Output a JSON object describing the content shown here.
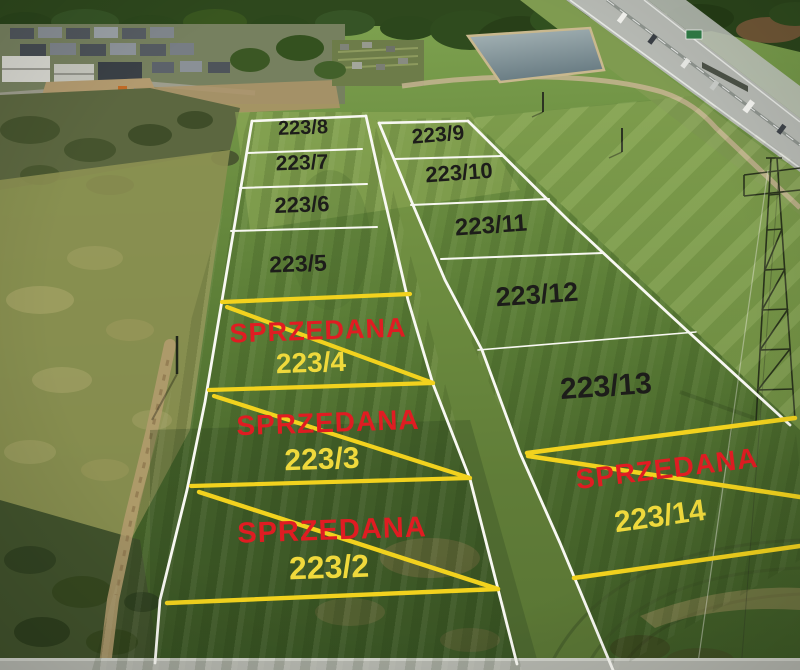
{
  "scene": {
    "type": "aerial-plot-sale-map",
    "sold_text": "SPRZEDANA",
    "colors": {
      "boundary_white": "#f8f8f2",
      "sold_yellow_line": "#f2d21e",
      "sold_red_text": "#e01c22",
      "sold_number_yellow": "#efd93c",
      "available_number_dark": "#1d1d1a"
    }
  },
  "plots": {
    "available": [
      {
        "number": "223/8",
        "x": 303,
        "y": 128,
        "size": 20,
        "rot": -2
      },
      {
        "number": "223/7",
        "x": 302,
        "y": 163,
        "size": 21,
        "rot": -2
      },
      {
        "number": "223/6",
        "x": 302,
        "y": 205,
        "size": 22,
        "rot": -2
      },
      {
        "number": "223/5",
        "x": 298,
        "y": 264,
        "size": 23,
        "rot": -2
      },
      {
        "number": "223/9",
        "x": 438,
        "y": 135,
        "size": 21,
        "rot": -5
      },
      {
        "number": "223/10",
        "x": 459,
        "y": 173,
        "size": 22,
        "rot": -4
      },
      {
        "number": "223/11",
        "x": 491,
        "y": 226,
        "size": 24,
        "rot": -4
      },
      {
        "number": "223/12",
        "x": 537,
        "y": 295,
        "size": 27,
        "rot": -4
      },
      {
        "number": "223/13",
        "x": 606,
        "y": 387,
        "size": 30,
        "rot": -4
      }
    ],
    "sold": [
      {
        "number": "223/4",
        "x": 311,
        "y": 363,
        "size": 28,
        "rot": -2,
        "badge_x": 318,
        "badge_y": 331,
        "badge_size": 27,
        "badge_rot": -2
      },
      {
        "number": "223/3",
        "x": 322,
        "y": 460,
        "size": 30,
        "rot": -2,
        "badge_x": 328,
        "badge_y": 423,
        "badge_size": 28,
        "badge_rot": -2
      },
      {
        "number": "223/2",
        "x": 329,
        "y": 567,
        "size": 32,
        "rot": -2,
        "badge_x": 332,
        "badge_y": 531,
        "badge_size": 29,
        "badge_rot": -2
      },
      {
        "number": "223/14",
        "x": 660,
        "y": 517,
        "size": 30,
        "rot": -8,
        "badge_x": 667,
        "badge_y": 469,
        "badge_size": 28,
        "badge_rot": -7
      }
    ]
  },
  "overlay": {
    "white_lines": [
      {
        "name": "left-column-west-boundary",
        "w": 2.8,
        "points": [
          [
            252,
            121
          ],
          [
            205,
            402
          ],
          [
            187,
            490
          ],
          [
            160,
            600
          ],
          [
            155,
            663
          ]
        ]
      },
      {
        "name": "left-column-north-boundary",
        "w": 2.6,
        "points": [
          [
            252,
            121
          ],
          [
            366,
            116
          ]
        ]
      },
      {
        "name": "left-column-east-boundary",
        "w": 2.8,
        "points": [
          [
            366,
            116
          ],
          [
            382,
            188
          ],
          [
            408,
            300
          ],
          [
            433,
            384
          ],
          [
            470,
            479
          ],
          [
            498,
            589
          ],
          [
            517,
            664
          ]
        ]
      },
      {
        "name": "divider-223-8-223-7",
        "w": 2.0,
        "points": [
          [
            247,
            153
          ],
          [
            362,
            149
          ]
        ]
      },
      {
        "name": "divider-223-7-223-6",
        "w": 2.0,
        "points": [
          [
            240,
            188
          ],
          [
            367,
            184
          ]
        ]
      },
      {
        "name": "divider-223-6-223-5",
        "w": 2.0,
        "points": [
          [
            231,
            231
          ],
          [
            377,
            227
          ]
        ]
      },
      {
        "name": "right-column-west-boundary",
        "w": 2.8,
        "points": [
          [
            379,
            123
          ],
          [
            413,
            205
          ],
          [
            445,
            280
          ],
          [
            482,
            350
          ],
          [
            520,
            453
          ],
          [
            560,
            543
          ],
          [
            613,
            670
          ]
        ]
      },
      {
        "name": "right-column-north-boundary",
        "w": 2.6,
        "points": [
          [
            379,
            123
          ],
          [
            468,
            121
          ]
        ]
      },
      {
        "name": "right-column-east-boundary",
        "w": 2.8,
        "points": [
          [
            468,
            121
          ],
          [
            570,
            222
          ],
          [
            670,
            315
          ],
          [
            790,
            425
          ]
        ]
      },
      {
        "name": "divider-223-9-223-10",
        "w": 2.0,
        "points": [
          [
            395,
            159
          ],
          [
            503,
            156
          ]
        ]
      },
      {
        "name": "divider-223-10-223-11",
        "w": 2.0,
        "points": [
          [
            411,
            205
          ],
          [
            549,
            199
          ]
        ]
      },
      {
        "name": "divider-223-11-223-12",
        "w": 2.0,
        "points": [
          [
            441,
            259
          ],
          [
            603,
            253
          ]
        ]
      },
      {
        "name": "divider-223-12-223-13",
        "w": 1.6,
        "points": [
          [
            478,
            350
          ],
          [
            696,
            332
          ]
        ]
      }
    ],
    "yellow_lines": [
      {
        "name": "sold-223-4-top-line",
        "w": 4.2,
        "points": [
          [
            222,
            302
          ],
          [
            410,
            294
          ]
        ]
      },
      {
        "name": "sold-223-4-diagonal",
        "w": 4.2,
        "points": [
          [
            227,
            307
          ],
          [
            433,
            383
          ]
        ]
      },
      {
        "name": "sold-223-4-bottom-line",
        "w": 4.2,
        "points": [
          [
            209,
            390
          ],
          [
            433,
            383
          ]
        ]
      },
      {
        "name": "sold-223-3-diagonal",
        "w": 4.2,
        "points": [
          [
            214,
            396
          ],
          [
            470,
            478
          ]
        ]
      },
      {
        "name": "sold-223-3-bottom-line",
        "w": 4.2,
        "points": [
          [
            191,
            486
          ],
          [
            470,
            478
          ]
        ]
      },
      {
        "name": "sold-223-2-diagonal",
        "w": 4.4,
        "points": [
          [
            199,
            492
          ],
          [
            498,
            589
          ]
        ]
      },
      {
        "name": "sold-223-2-bottom-line",
        "w": 4.4,
        "points": [
          [
            167,
            603
          ],
          [
            498,
            589
          ]
        ]
      },
      {
        "name": "sold-223-14-top-line",
        "w": 4.5,
        "points": [
          [
            527,
            453
          ],
          [
            795,
            418
          ]
        ]
      },
      {
        "name": "sold-223-14-diagonal",
        "w": 4.5,
        "points": [
          [
            528,
            456
          ],
          [
            800,
            497
          ]
        ]
      },
      {
        "name": "sold-223-14-bottom-line",
        "w": 4.5,
        "points": [
          [
            574,
            578
          ],
          [
            800,
            546
          ]
        ]
      }
    ]
  }
}
